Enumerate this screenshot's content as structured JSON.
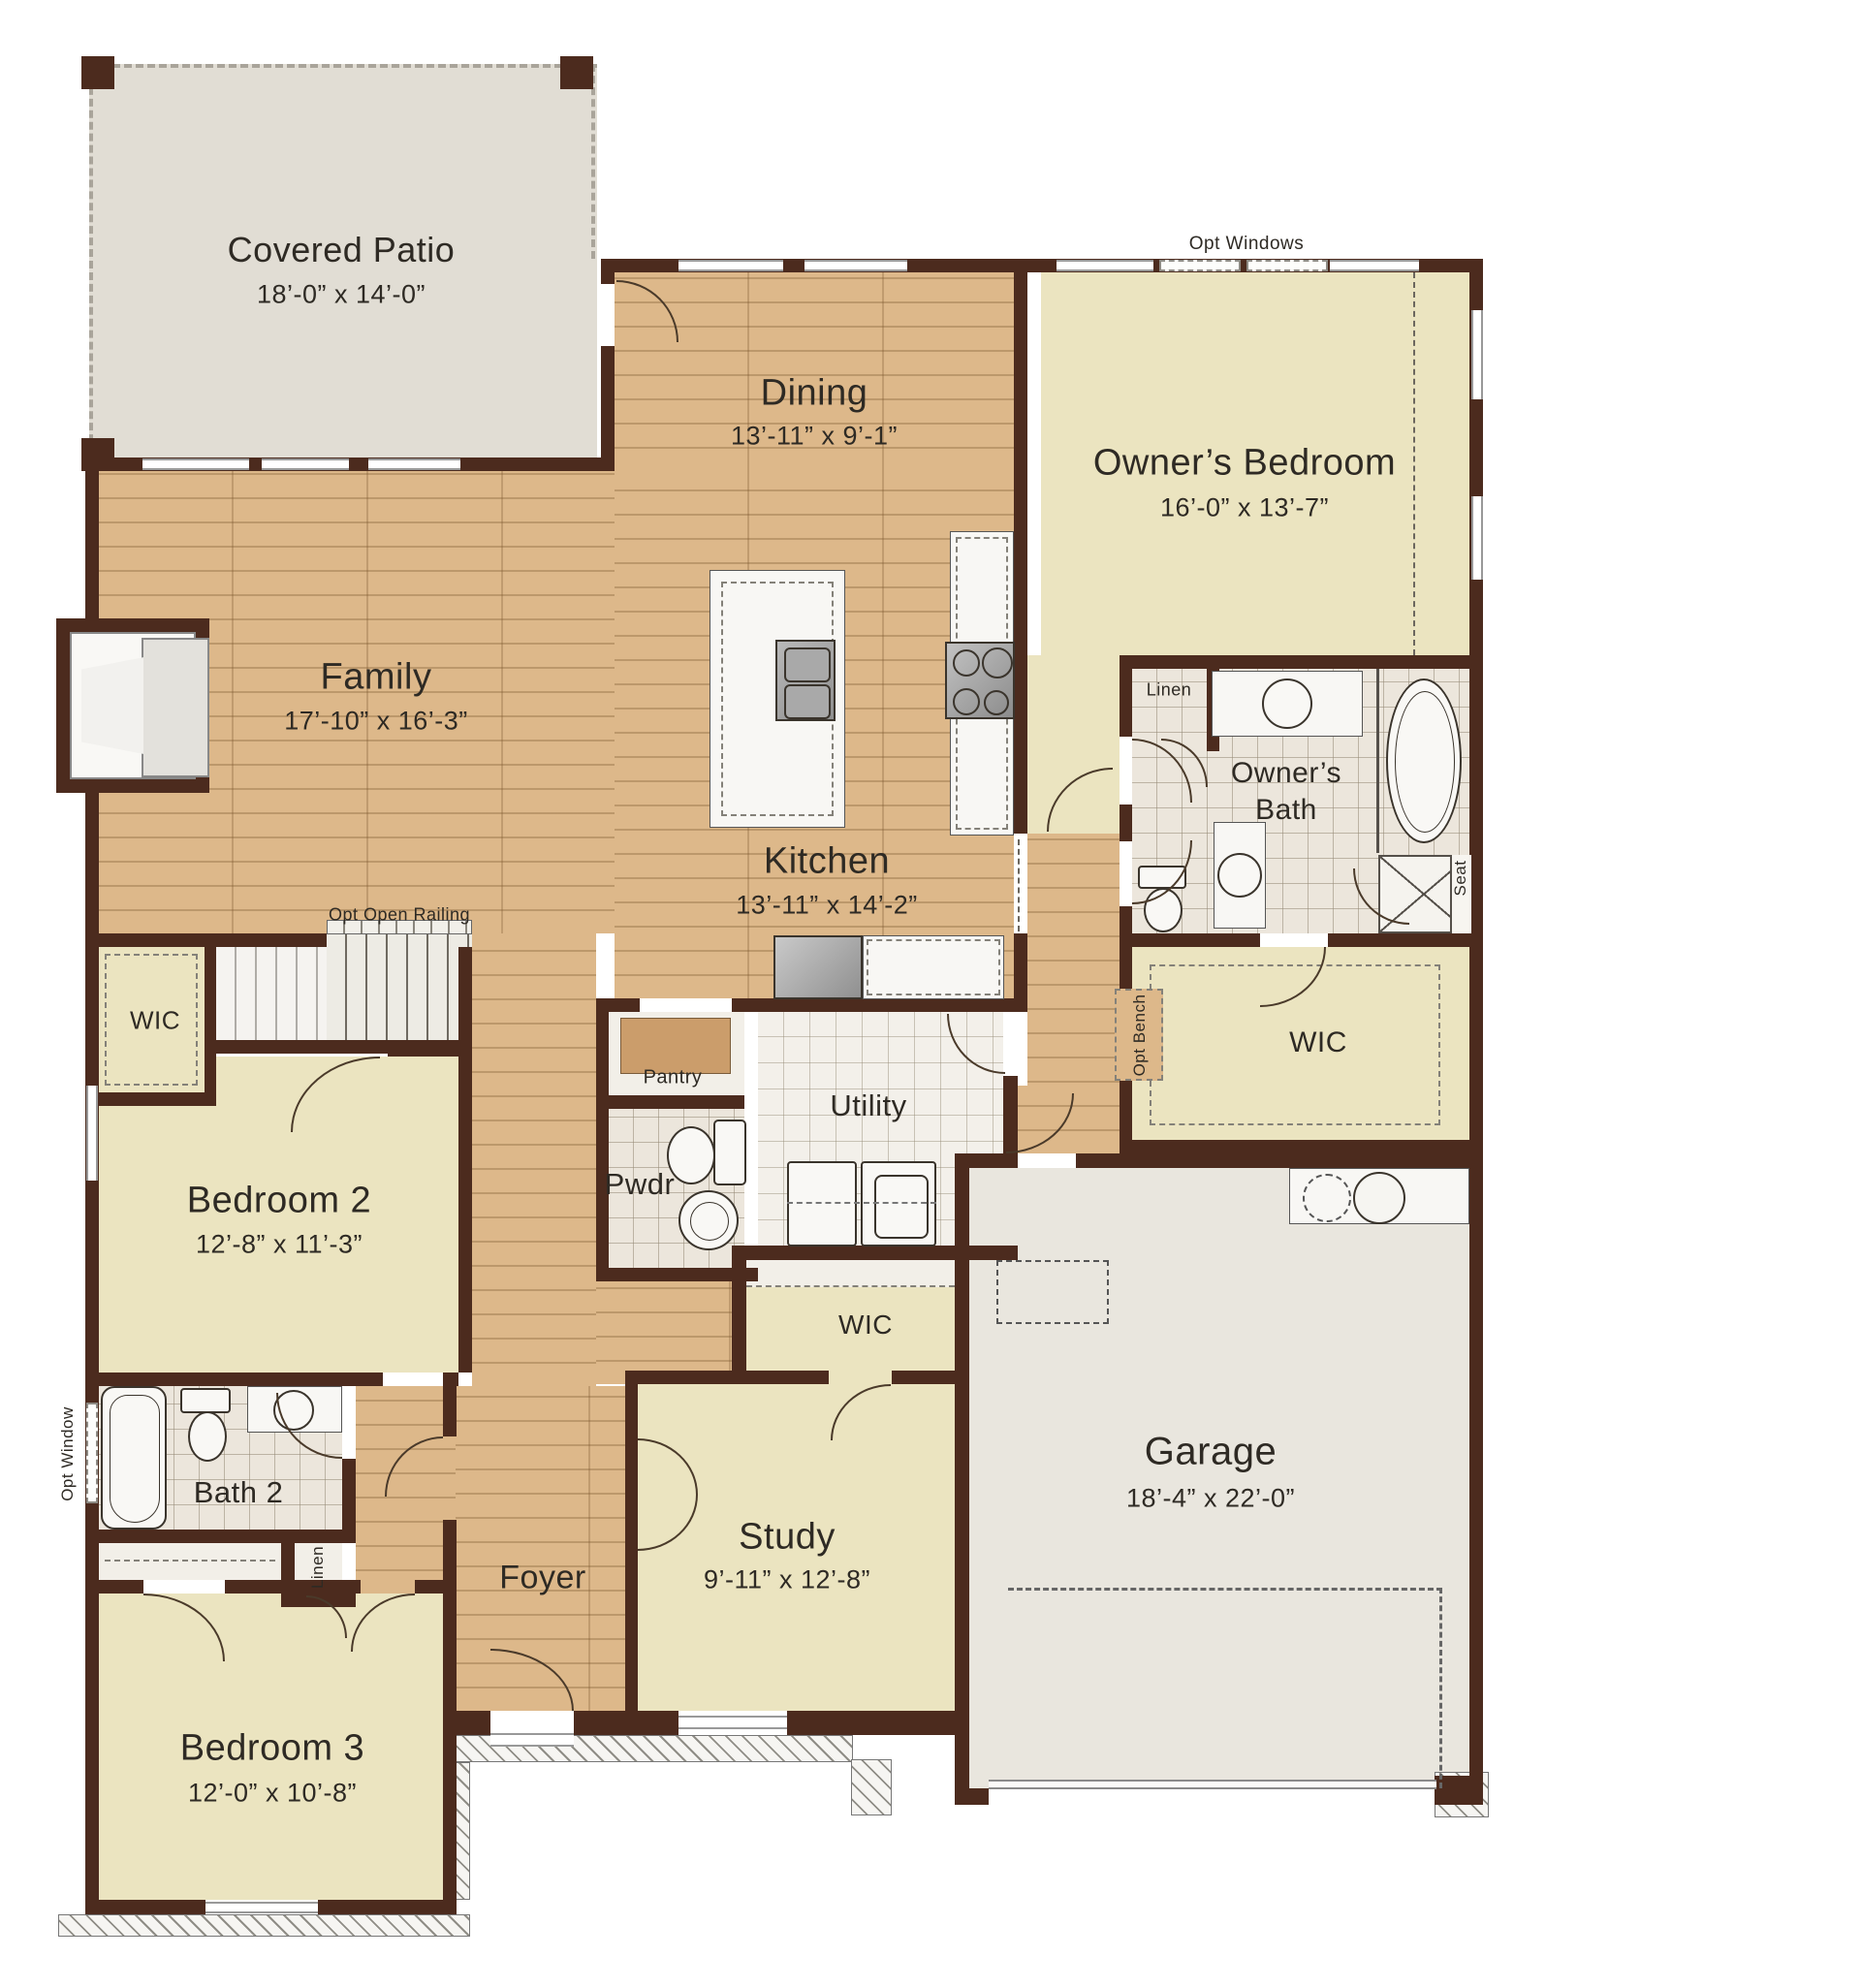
{
  "rooms": {
    "covered_patio": {
      "name": "Covered Patio",
      "dims": "18’-0” x 14’-0”"
    },
    "dining": {
      "name": "Dining",
      "dims": "13’-11” x 9’-1”"
    },
    "owners_bedroom": {
      "name": "Owner’s Bedroom",
      "dims": "16’-0” x 13’-7”"
    },
    "family": {
      "name": "Family",
      "dims": "17’-10” x 16’-3”"
    },
    "kitchen": {
      "name": "Kitchen",
      "dims": "13’-11” x 14’-2”"
    },
    "owners_bath": {
      "name_line1": "Owner’s",
      "name_line2": "Bath"
    },
    "utility": {
      "name": "Utility"
    },
    "pantry": {
      "name": "Pantry"
    },
    "pwdr": {
      "name": "Pwdr"
    },
    "bedroom2": {
      "name": "Bedroom 2",
      "dims": "12’-8” x 11’-3”"
    },
    "bath2": {
      "name": "Bath 2"
    },
    "bedroom3": {
      "name": "Bedroom 3",
      "dims": "12’-0” x 10’-8”"
    },
    "foyer": {
      "name": "Foyer"
    },
    "study": {
      "name": "Study",
      "dims": "9’-11” x 12’-8”"
    },
    "garage": {
      "name": "Garage",
      "dims": "18’-4” x 22’-0”"
    }
  },
  "labels": {
    "wic": "WIC",
    "linen": "Linen",
    "seat": "Seat",
    "opt_windows": "Opt Windows",
    "opt_open_railing": "Opt Open Railing",
    "opt_window": "Opt Window",
    "opt_bench": "Opt Bench"
  },
  "colors": {
    "wall": "#4c2b1e",
    "wood": "#ddb88a",
    "carpet": "#ebe4c0",
    "tile": "#ece6dc",
    "utility_tile": "#f2efe9",
    "patio": "#e1ddd4",
    "garage": "#e9e6de",
    "counter": "#f8f7f4",
    "text": "#2e2a24"
  }
}
